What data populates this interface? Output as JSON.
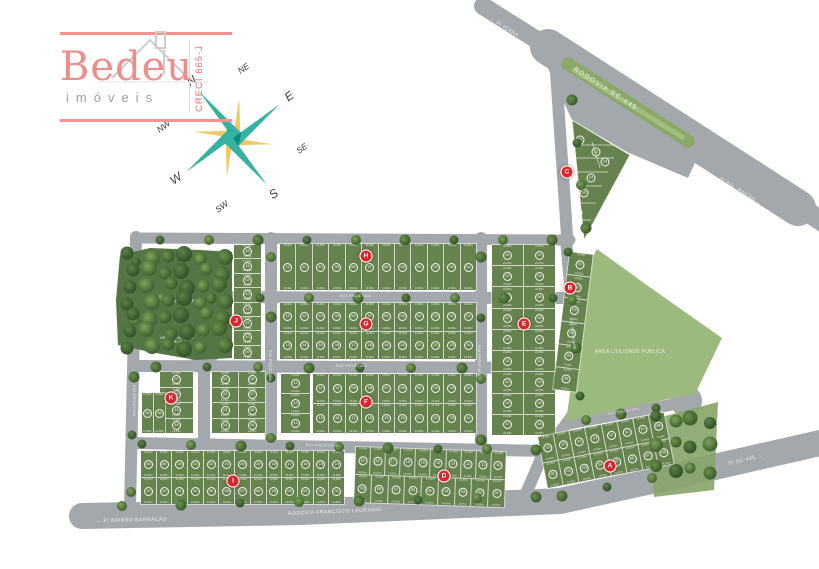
{
  "branding": {
    "name": "Bedeu",
    "tagline": "imóveis",
    "creci": "CRECI 665-J"
  },
  "compass": {
    "points": [
      "N",
      "NE",
      "E",
      "SE",
      "S",
      "SW",
      "W",
      "NW"
    ]
  },
  "roads": {
    "labels": [
      {
        "id": "icara",
        "text": "← P/ IÇARA"
      },
      {
        "id": "sc445",
        "text": "RODOVIA SC-445"
      },
      {
        "id": "rincao",
        "text": "P/ BAL. RINCÃO →"
      },
      {
        "id": "barracao",
        "text": "← P/ BAIRRO BARRACÃO"
      },
      {
        "id": "laurindo",
        "text": "RODOVIA FRANCISCO LAURINDO"
      },
      {
        "id": "sc445b",
        "text": "P/ SC-445 →"
      }
    ],
    "street_label": "RUA PROJETADA"
  },
  "areas": [
    {
      "id": "verde",
      "label": "ÁREA VERDE"
    },
    {
      "id": "util-left",
      "label": "ÁREA UTILIDADE PÚBLICA"
    },
    {
      "id": "util-right",
      "label": "ÁREA UTILIDADE PÚBLICA"
    }
  ],
  "colors": {
    "badge_red": "#d8262d",
    "lot_green": "#66824e",
    "road_gray": "#a3a8ac",
    "public_green": "#9cb97e",
    "brand_pink": "#ee8d8a",
    "compass_teal": "#0a8a7d",
    "compass_gold": "#d09a26"
  },
  "blocks": [
    {
      "id": "H",
      "letter": "H",
      "dim": "13,00m",
      "rows": [
        [
          "12",
          "11",
          "10",
          "09",
          "08",
          "07",
          "06",
          "05",
          "04",
          "03",
          "02",
          "01"
        ]
      ]
    },
    {
      "id": "G",
      "letter": "G",
      "dim": "13,00m",
      "rows": [
        [
          "12",
          "11",
          "10",
          "09",
          "08",
          "07",
          "06",
          "05",
          "04",
          "03",
          "02",
          "01"
        ],
        [
          "13",
          "14",
          "15",
          "16",
          "17",
          "18",
          "19",
          "20",
          "21",
          "22",
          "23",
          "24"
        ]
      ]
    },
    {
      "id": "Fw",
      "letter": "",
      "dim": "13,00m",
      "rows": [
        [
          "12"
        ],
        [
          "13"
        ],
        [
          "14"
        ]
      ]
    },
    {
      "id": "F",
      "letter": "F",
      "dim": "13,00m",
      "rows": [
        [
          "11",
          "10",
          "09",
          "08",
          "07",
          "06",
          "05",
          "04",
          "03",
          "02"
        ],
        [
          "15",
          "16",
          "17",
          "18",
          "19",
          "20",
          "21",
          "22",
          "23",
          "24"
        ]
      ]
    },
    {
      "id": "E",
      "letter": "E",
      "dim": "23,45m",
      "rows": [
        [
          "01",
          "02"
        ],
        [
          "03",
          "04"
        ],
        [
          "05",
          "06"
        ],
        [
          "07",
          "08"
        ],
        [
          "09",
          "10"
        ],
        [
          "11",
          "12"
        ],
        [
          "13",
          "14"
        ],
        [
          "15",
          "16"
        ],
        [
          "17",
          "18"
        ]
      ]
    },
    {
      "id": "B",
      "letter": "B",
      "dim": "15,00m",
      "rows": [
        [
          "01"
        ],
        [
          "02"
        ],
        [
          "03"
        ],
        [
          "04"
        ],
        [
          "05"
        ],
        [
          "06"
        ]
      ]
    },
    {
      "id": "J",
      "letter": "J",
      "dim": "13,00m",
      "rows": [
        [
          "16"
        ],
        [
          "15"
        ],
        [
          "14"
        ],
        [
          "13"
        ],
        [
          "12"
        ],
        [
          "11"
        ],
        [
          "10"
        ],
        [
          "09"
        ]
      ]
    },
    {
      "id": "Kc",
      "letter": "K",
      "dim": "14,00m",
      "rows": [
        [
          "07"
        ],
        [
          "08"
        ],
        [
          "13"
        ],
        [
          "14"
        ]
      ]
    },
    {
      "id": "Kg",
      "letter": "",
      "dim": "14,00m",
      "rows": [
        [
          "01",
          "18"
        ],
        [
          "12",
          "17"
        ],
        [
          "13",
          "16"
        ],
        [
          "14",
          "15"
        ]
      ]
    },
    {
      "id": "Ks",
      "letter": "",
      "dim": "12,48m",
      "rows": [
        [
          "36",
          "35"
        ]
      ]
    },
    {
      "id": "I",
      "letter": "I",
      "dim": "12,00m",
      "rows": [
        [
          "26",
          "25",
          "24",
          "23",
          "22",
          "21",
          "20",
          "19",
          "18",
          "17",
          "16",
          "15",
          "14"
        ],
        [
          "13",
          "12",
          "11",
          "10",
          "09",
          "08",
          "07",
          "06",
          "05",
          "04",
          "03",
          "02",
          "01"
        ]
      ]
    },
    {
      "id": "D",
      "letter": "D",
      "dim": "14,00m",
      "rows": [
        [
          "19",
          "18",
          "17",
          "16",
          "15",
          "14",
          "13",
          "12",
          "11",
          "10"
        ],
        [
          "09",
          "08",
          "07",
          "06",
          "05",
          "04",
          "03",
          "02",
          "01"
        ]
      ]
    },
    {
      "id": "A",
      "letter": "A",
      "dim": "14,50m",
      "rows": [
        [
          "16",
          "15",
          "14",
          "13",
          "12",
          "11",
          "10",
          "09"
        ],
        [
          "01",
          "02",
          "03",
          "04",
          "05",
          "06",
          "07",
          "08"
        ]
      ]
    },
    {
      "id": "C",
      "letter": "C",
      "dim": "",
      "triangle": true,
      "rows": [
        [
          "01",
          "12",
          "13",
          "14",
          "15",
          "16"
        ]
      ]
    }
  ]
}
